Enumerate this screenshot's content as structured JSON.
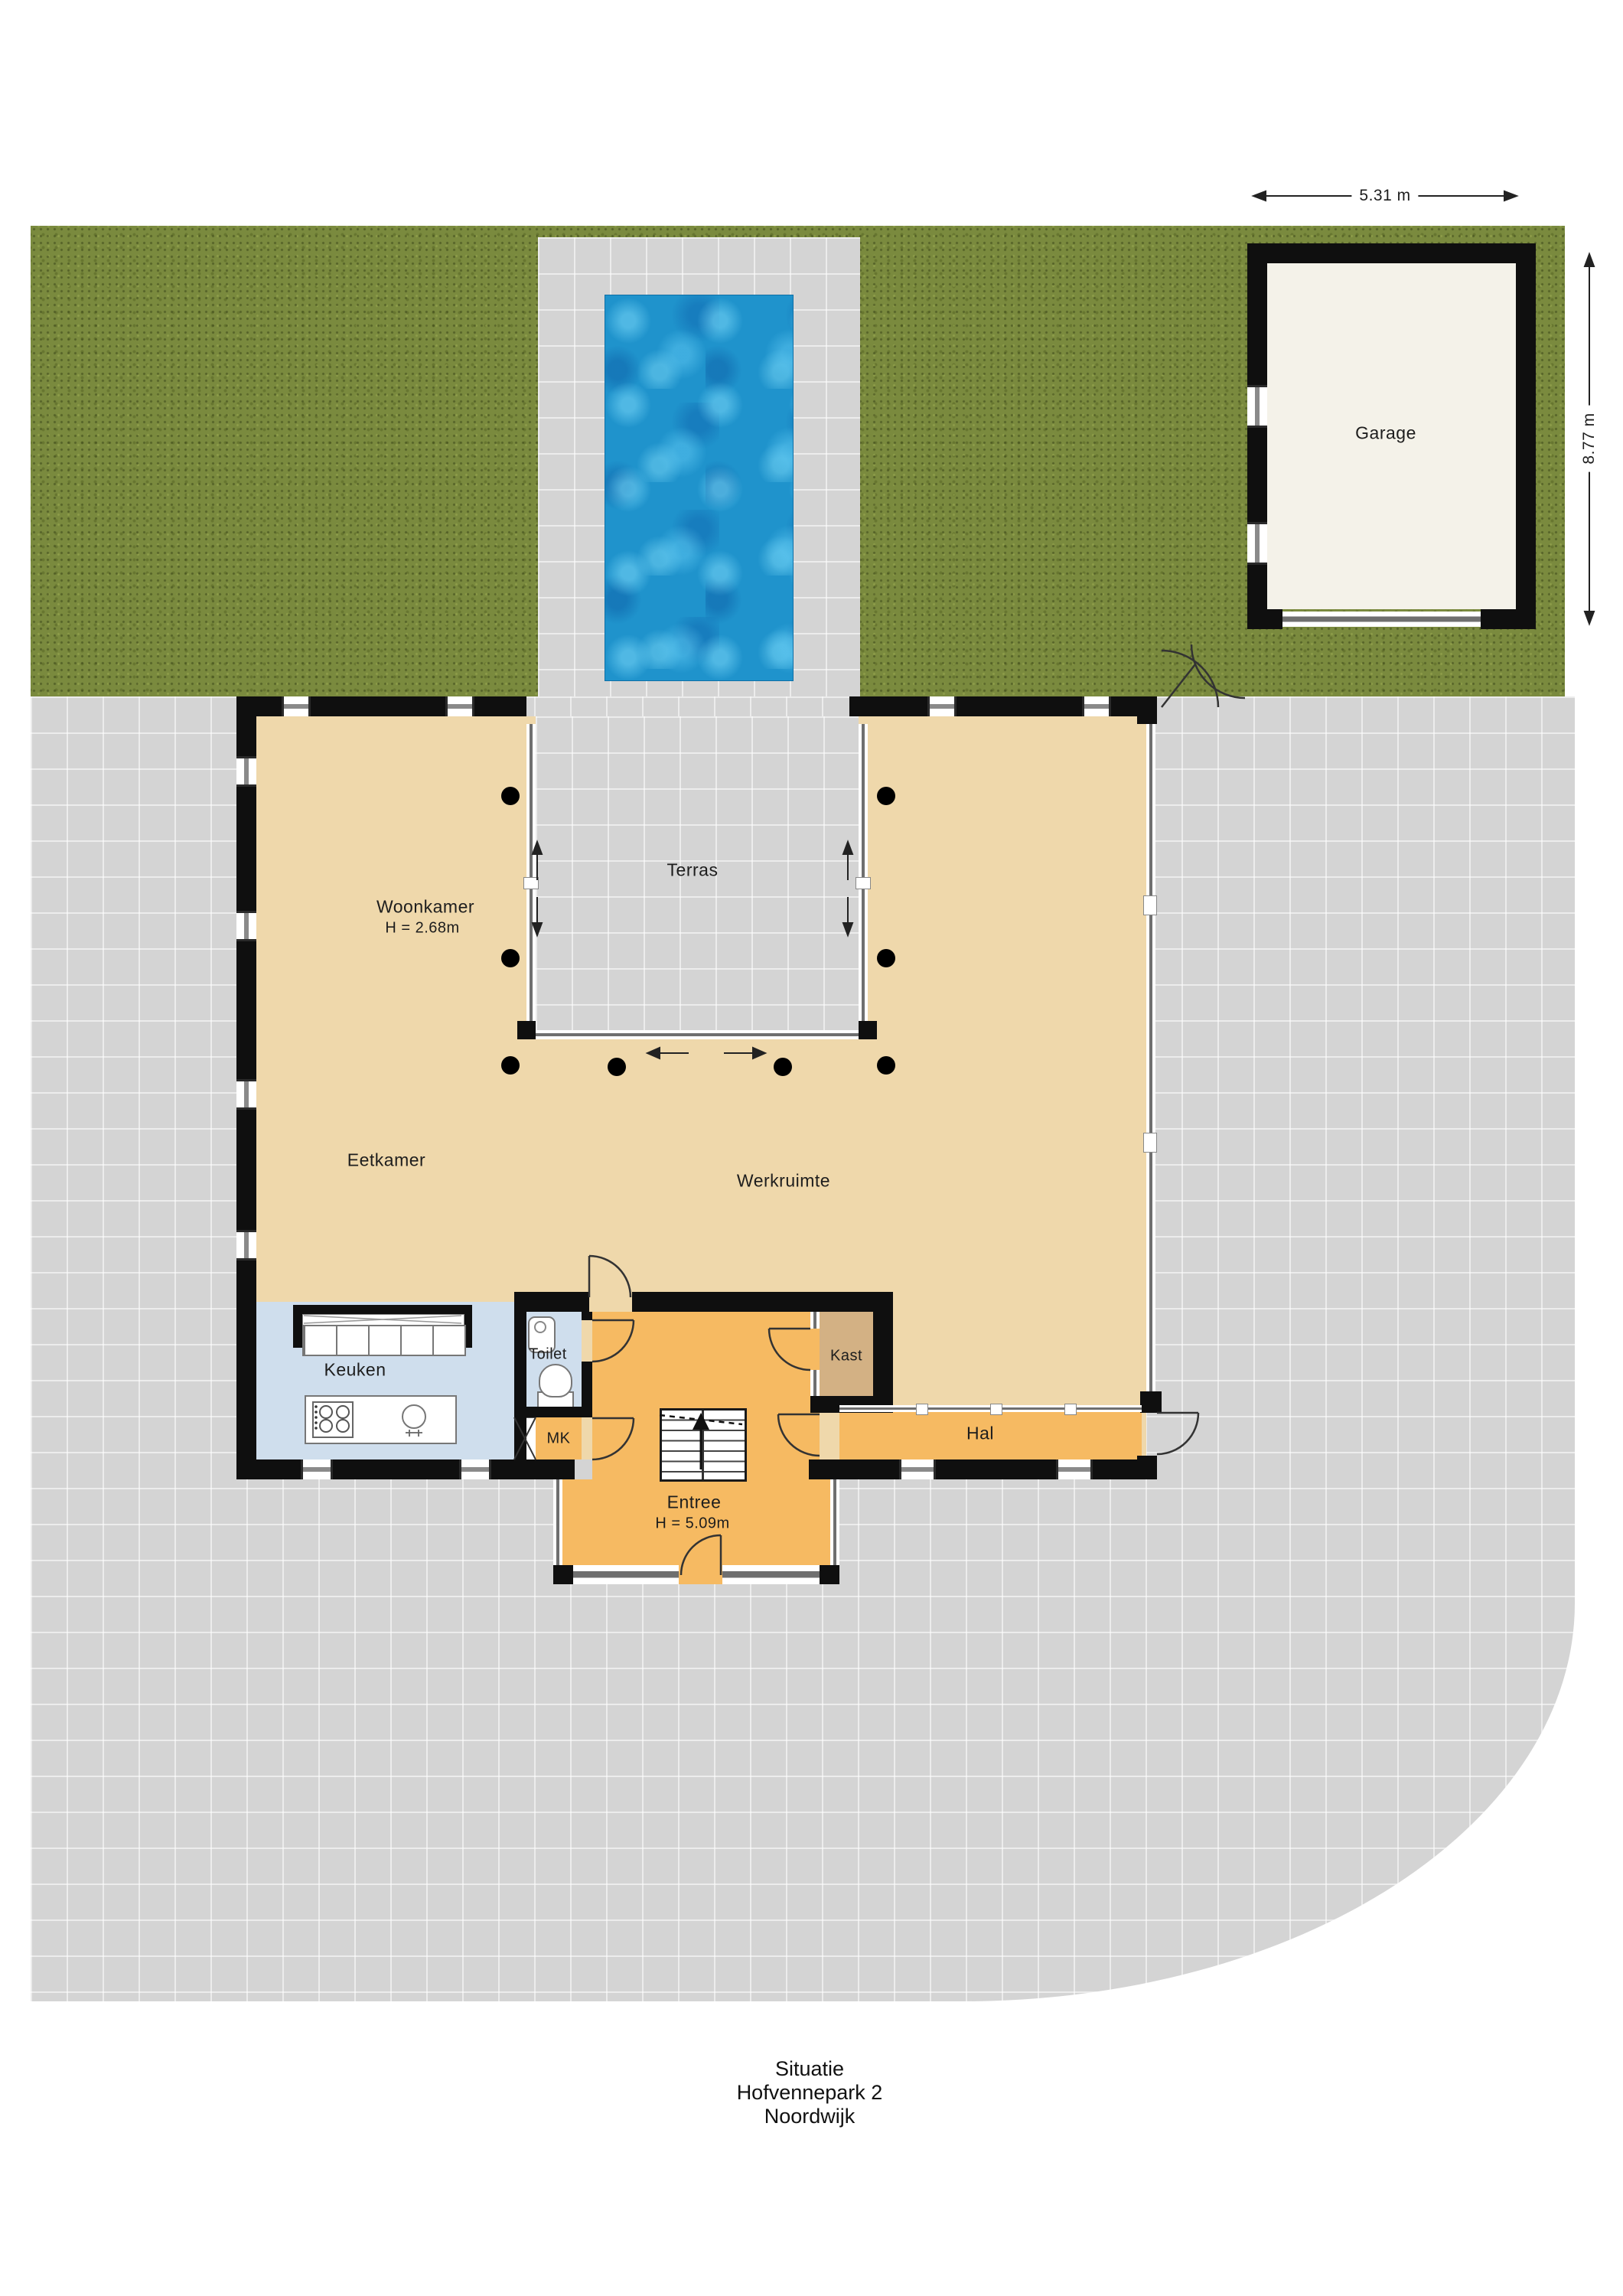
{
  "title_block": {
    "line1": "Situatie",
    "line2": "Hofvennepark 2",
    "line3": "Noordwijk"
  },
  "dimensions": {
    "garage_width": "5.31 m",
    "garage_depth": "8.77 m"
  },
  "rooms": {
    "garage": "Garage",
    "woonkamer": "Woonkamer",
    "woonkamer_height": "H = 2.68m",
    "terras": "Terras",
    "eetkamer": "Eetkamer",
    "werkruimte": "Werkruimte",
    "keuken": "Keuken",
    "toilet": "Toilet",
    "mk": "MK",
    "kast": "Kast",
    "entree": "Entree",
    "entree_height": "H = 5.09m",
    "hal": "Hal"
  },
  "colors": {
    "grass": "#7a8a3e",
    "paving": "#d4d4d4",
    "floor-beige": "#efd8ab",
    "floor-orange": "#f6ba62",
    "floor-blue": "#cfdeed",
    "floor-tan": "#d3b184",
    "garage-floor": "#f4f2e9",
    "wall": "#0f0f0f",
    "pool-base": "#1f93cc",
    "glass-line": "#6f6f6f"
  }
}
